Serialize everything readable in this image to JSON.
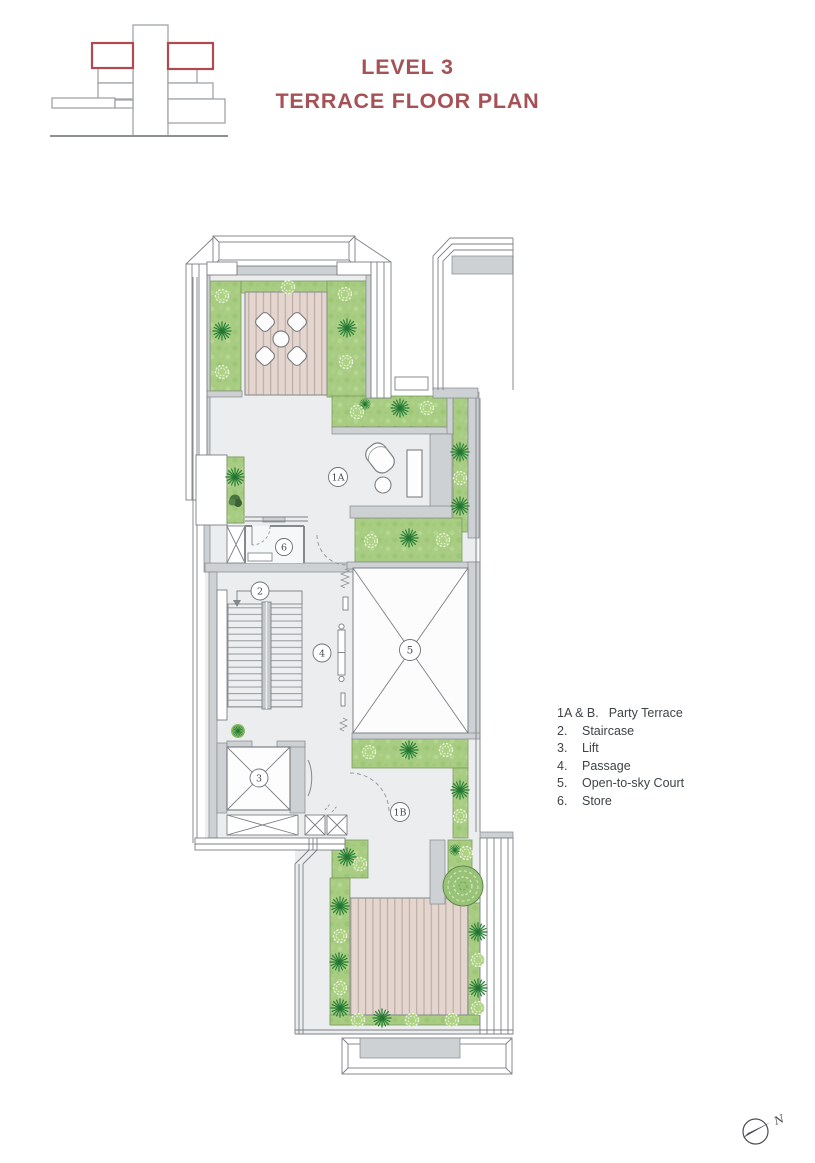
{
  "title": {
    "line1": "LEVEL 3",
    "line2": "TERRACE FLOOR PLAN"
  },
  "legend": {
    "items": [
      {
        "num": "1A & B.",
        "label": "Party Terrace"
      },
      {
        "num": "2.",
        "label": "Staircase"
      },
      {
        "num": "3.",
        "label": "Lift"
      },
      {
        "num": "4.",
        "label": "Passage"
      },
      {
        "num": "5.",
        "label": "Open-to-sky Court"
      },
      {
        "num": "6.",
        "label": "Store"
      }
    ]
  },
  "plan": {
    "labels": {
      "terrace_a": "1A",
      "terrace_b": "1B",
      "staircase": "2",
      "lift": "3",
      "passage": "4",
      "court": "5",
      "store": "6"
    }
  },
  "north": {
    "label": "N"
  },
  "colors": {
    "title_accent": "#a65156",
    "keyplan_highlight": "#b04a50",
    "grass": "#a8cd82",
    "plant_dark_green": "#2f8c3f",
    "deck": "#e2d3cb",
    "wall_gray": "#ced1d3",
    "line_gray": "#7b7f83",
    "floor": "#ecedef"
  }
}
